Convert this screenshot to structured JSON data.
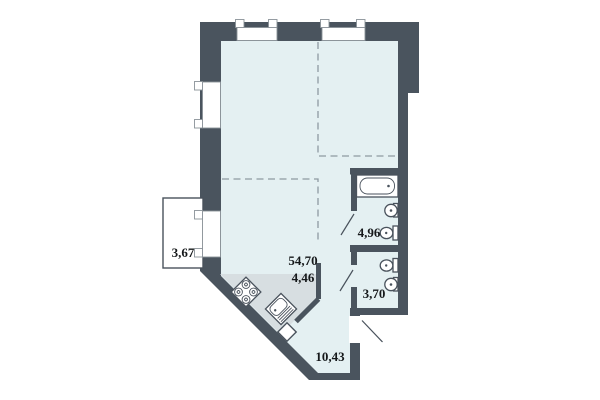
{
  "plan": {
    "title": "Apartment floor plan",
    "rooms": [
      {
        "id": "balcony",
        "area_label": "3,67"
      },
      {
        "id": "living-room",
        "area_label": "54,70"
      },
      {
        "id": "kitchen",
        "area_label": "4,46"
      },
      {
        "id": "bathroom",
        "area_label": "4,96"
      },
      {
        "id": "toilet",
        "area_label": "3,70"
      },
      {
        "id": "hallway",
        "area_label": "10,43"
      }
    ],
    "fixtures": [
      "bathtub",
      "bathroom-sink",
      "bathroom-toilet",
      "toilet-room-toilet",
      "toilet-room-sink",
      "stove",
      "kitchen-sink"
    ],
    "colors": {
      "wall": "#4a545e",
      "floor": "#e4f0f2",
      "kitchen_zone": "#d7dee1",
      "background": "#ffffff",
      "opening_outline": "#8a9298"
    }
  }
}
